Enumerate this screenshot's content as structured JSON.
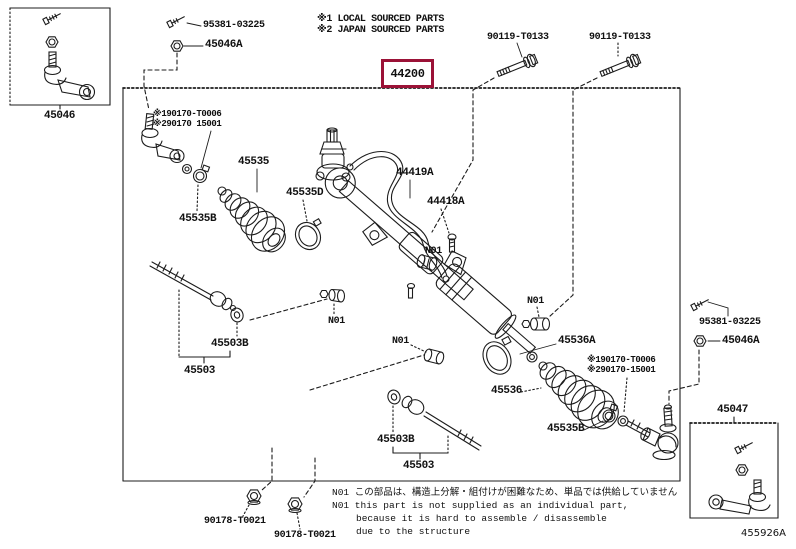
{
  "legend": {
    "l1": "※1 LOCAL SOURCED PARTS",
    "l2": "※2 JAPAN SOURCED PARTS"
  },
  "labels": {
    "n44200": "44200",
    "n45046": "45046",
    "n45046a": "45046A",
    "n95381": "95381-03225",
    "n90119": "90119-T0133",
    "n45535": "45535",
    "n45535b": "45535B",
    "n45535d": "45535D",
    "n44419a": "44419A",
    "n44418a": "44418A",
    "n45503": "45503",
    "n45503b": "45503B",
    "n45536": "45536",
    "n45536a": "45536A",
    "n45047": "45047",
    "n90178": "90178-T0021",
    "n01": "N01"
  },
  "grease_left": {
    "l1": "※190170-T0006",
    "l2": "※290170 15001"
  },
  "grease_right": {
    "l1": "※190170-T0006",
    "l2": "※290170-15001"
  },
  "notes": {
    "jp": "N01 この部品は、構造上分解・組付けが困難なため、単品では供給していません",
    "en1": "N01 this part is not supplied as an individual part,",
    "en2": "because it is hard to assemble / disassemble",
    "en3": "due to the structure"
  },
  "figure_code": "455926A",
  "colors": {
    "highlight_box": "#9b1237",
    "line": "#1c1c1c",
    "background": "#ffffff"
  }
}
